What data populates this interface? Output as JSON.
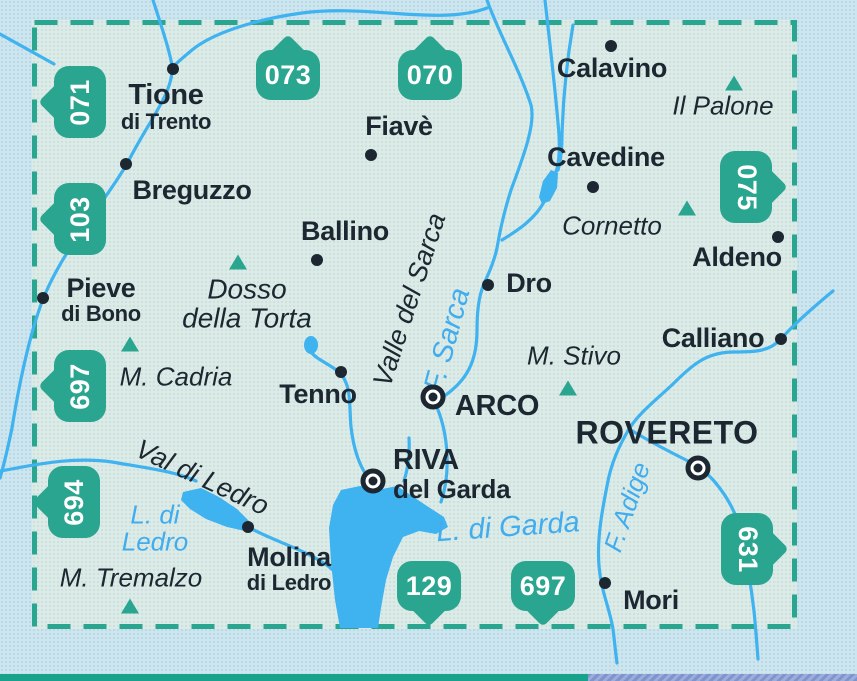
{
  "colors": {
    "teal": "#2aa58f",
    "water": "#3fb2f0",
    "water_label": "#41acee",
    "label": "#1d2731",
    "inside_bg": "#dcebe7",
    "outside_bg": "#cde5ee",
    "band_teal": "#18a28c",
    "band_blue": "#7e93cf"
  },
  "badges": [
    {
      "number": "071",
      "direction": "left"
    },
    {
      "number": "073",
      "direction": "up"
    },
    {
      "number": "070",
      "direction": "up"
    },
    {
      "number": "103",
      "direction": "left"
    },
    {
      "number": "075",
      "direction": "right"
    },
    {
      "number": "697",
      "direction": "left"
    },
    {
      "number": "694",
      "direction": "left"
    },
    {
      "number": "129",
      "direction": "down"
    },
    {
      "number": "697",
      "direction": "down"
    },
    {
      "number": "631",
      "direction": "right"
    }
  ],
  "towns": [
    {
      "lines": [
        "Tione",
        "di Trento"
      ],
      "symbol": "dot"
    },
    {
      "lines": [
        "Breguzzo"
      ],
      "symbol": "dot"
    },
    {
      "lines": [
        "Fiavè"
      ],
      "symbol": "dot"
    },
    {
      "lines": [
        "Calavino"
      ],
      "symbol": "dot"
    },
    {
      "lines": [
        "Cavedine"
      ],
      "symbol": "dot"
    },
    {
      "lines": [
        "Aldeno"
      ],
      "symbol": "dot"
    },
    {
      "lines": [
        "Calliano"
      ],
      "symbol": "dot"
    },
    {
      "lines": [
        "Ballino"
      ],
      "symbol": "dot"
    },
    {
      "lines": [
        "Pieve",
        "di Bono"
      ],
      "symbol": "dot"
    },
    {
      "lines": [
        "Dro"
      ],
      "symbol": "dot"
    },
    {
      "lines": [
        "Tenno"
      ],
      "symbol": "dot"
    },
    {
      "lines": [
        "ARCO"
      ],
      "symbol": "ring"
    },
    {
      "lines": [
        "RIVA",
        "del Garda"
      ],
      "symbol": "ring"
    },
    {
      "lines": [
        "ROVERETO"
      ],
      "symbol": "ring"
    },
    {
      "lines": [
        "Molina",
        "di Ledro"
      ],
      "symbol": "dot"
    },
    {
      "lines": [
        "Mori"
      ],
      "symbol": "dot"
    }
  ],
  "peaks": [
    {
      "lines": [
        "Il Palone"
      ]
    },
    {
      "lines": [
        "Cornetto"
      ]
    },
    {
      "lines": [
        "Dosso",
        "della Torta"
      ]
    },
    {
      "lines": [
        "M. Cadria"
      ]
    },
    {
      "lines": [
        "M. Stivo"
      ]
    },
    {
      "lines": [
        "M. Tremalzo"
      ]
    }
  ],
  "valleys": [
    {
      "name": "Valle del Sarca"
    },
    {
      "name": "Val di Ledro"
    }
  ],
  "water_labels": [
    {
      "lines": [
        "F. Sarca"
      ]
    },
    {
      "lines": [
        "L. di Garda"
      ]
    },
    {
      "lines": [
        "L. di",
        "Ledro"
      ]
    },
    {
      "lines": [
        "F. Adige"
      ]
    }
  ]
}
